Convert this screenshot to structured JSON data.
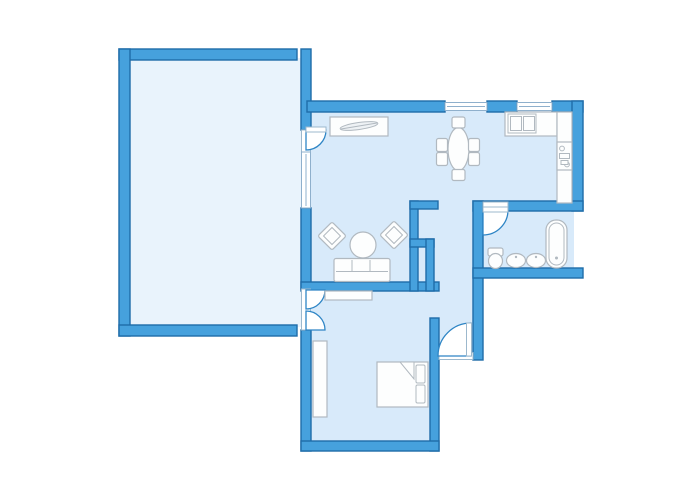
{
  "canvas": {
    "width": 700,
    "height": 500,
    "background": "#ffffff"
  },
  "palette": {
    "wall_fill": "#46a1dd",
    "wall_stroke": "#1e6ca9",
    "room_fill": "#d8eafa",
    "terrace_fill": "#e9f3fc",
    "opening_fill": "#ffffff",
    "opening_stroke": "#9cb8cd",
    "window_stroke": "#8fb0cc",
    "door_arc_stroke": "#2e85c5",
    "furniture_fill": "#fdfefe",
    "furniture_stroke": "#b1b9c0",
    "decor_fill": "#eef2f5"
  },
  "shapes": [
    {
      "name": "terrace-room-floor",
      "kind": "rect",
      "x": 128,
      "y": 58,
      "w": 175,
      "h": 269,
      "fill": "#e9f3fc"
    },
    {
      "name": "dining-kitchen-floor",
      "kind": "rect",
      "x": 306,
      "y": 110,
      "w": 268,
      "h": 95,
      "fill": "#d8eafa"
    },
    {
      "name": "living-room-floor",
      "kind": "rect",
      "x": 306,
      "y": 203,
      "w": 169,
      "h": 82,
      "fill": "#d8eafa"
    },
    {
      "name": "corridor-floor",
      "kind": "rect",
      "x": 430,
      "y": 285,
      "w": 47,
      "h": 70,
      "fill": "#d8eafa"
    },
    {
      "name": "bedroom-floor",
      "kind": "rect",
      "x": 306,
      "y": 285,
      "w": 130,
      "h": 158,
      "fill": "#d8eafa"
    },
    {
      "name": "bathroom-floor",
      "kind": "rect",
      "x": 481,
      "y": 209,
      "w": 93,
      "h": 61,
      "fill": "#d8eafa"
    },
    {
      "name": "wall-terrace-top",
      "kind": "rect",
      "x": 119,
      "y": 49,
      "w": 178,
      "h": 11,
      "fill": "#46a1dd",
      "stroke": "#1e6ca9",
      "sw": 1.4
    },
    {
      "name": "wall-terrace-left",
      "kind": "rect",
      "x": 119,
      "y": 49,
      "w": 11,
      "h": 287,
      "fill": "#46a1dd",
      "stroke": "#1e6ca9",
      "sw": 1.4
    },
    {
      "name": "wall-terrace-bottom",
      "kind": "rect",
      "x": 119,
      "y": 325,
      "w": 178,
      "h": 11,
      "fill": "#46a1dd",
      "stroke": "#1e6ca9",
      "sw": 1.4
    },
    {
      "name": "wall-west-upper",
      "kind": "rect",
      "x": 301,
      "y": 49,
      "w": 10,
      "h": 81,
      "fill": "#46a1dd",
      "stroke": "#1e6ca9",
      "sw": 1.4
    },
    {
      "name": "wall-west-mid",
      "kind": "rect",
      "x": 301,
      "y": 208,
      "w": 10,
      "h": 81,
      "fill": "#46a1dd",
      "stroke": "#1e6ca9",
      "sw": 1.4
    },
    {
      "name": "wall-west-lower",
      "kind": "rect",
      "x": 301,
      "y": 330,
      "w": 10,
      "h": 121,
      "fill": "#46a1dd",
      "stroke": "#1e6ca9",
      "sw": 1.4
    },
    {
      "name": "wall-north-1",
      "kind": "rect",
      "x": 307,
      "y": 101,
      "w": 138,
      "h": 11,
      "fill": "#46a1dd",
      "stroke": "#1e6ca9",
      "sw": 1.4
    },
    {
      "name": "wall-north-2",
      "kind": "rect",
      "x": 487,
      "y": 101,
      "w": 30,
      "h": 11,
      "fill": "#46a1dd",
      "stroke": "#1e6ca9",
      "sw": 1.4
    },
    {
      "name": "wall-north-3",
      "kind": "rect",
      "x": 552,
      "y": 101,
      "w": 31,
      "h": 11,
      "fill": "#46a1dd",
      "stroke": "#1e6ca9",
      "sw": 1.4
    },
    {
      "name": "wall-east-upper",
      "kind": "rect",
      "x": 572,
      "y": 101,
      "w": 11,
      "h": 110,
      "fill": "#46a1dd",
      "stroke": "#1e6ca9",
      "sw": 1.4
    },
    {
      "name": "wall-bathroom-top",
      "kind": "rect",
      "x": 473,
      "y": 201,
      "w": 110,
      "h": 10,
      "fill": "#46a1dd",
      "stroke": "#1e6ca9",
      "sw": 1.4
    },
    {
      "name": "wall-bathroom-left",
      "kind": "rect",
      "x": 473,
      "y": 201,
      "w": 10,
      "h": 159,
      "fill": "#46a1dd",
      "stroke": "#1e6ca9",
      "sw": 1.4
    },
    {
      "name": "wall-bathroom-bottom",
      "kind": "rect",
      "x": 473,
      "y": 268,
      "w": 110,
      "h": 10,
      "fill": "#46a1dd",
      "stroke": "#1e6ca9",
      "sw": 1.4
    },
    {
      "name": "wall-living-bottom",
      "kind": "rect",
      "x": 301,
      "y": 282,
      "w": 138,
      "h": 9,
      "fill": "#46a1dd",
      "stroke": "#1e6ca9",
      "sw": 1.4
    },
    {
      "name": "wall-closet-spine",
      "kind": "rect",
      "x": 410,
      "y": 201,
      "w": 8,
      "h": 90,
      "fill": "#46a1dd",
      "stroke": "#1e6ca9",
      "sw": 1.4
    },
    {
      "name": "wall-closet-top-arm",
      "kind": "rect",
      "x": 410,
      "y": 201,
      "w": 28,
      "h": 8,
      "fill": "#46a1dd",
      "stroke": "#1e6ca9",
      "sw": 1.4
    },
    {
      "name": "wall-closet-mid-arm",
      "kind": "rect",
      "x": 410,
      "y": 239,
      "w": 24,
      "h": 8,
      "fill": "#46a1dd",
      "stroke": "#1e6ca9",
      "sw": 1.4
    },
    {
      "name": "wall-closet-right",
      "kind": "rect",
      "x": 426,
      "y": 239,
      "w": 8,
      "h": 52,
      "fill": "#46a1dd",
      "stroke": "#1e6ca9",
      "sw": 1.4
    },
    {
      "name": "wall-bedroom-east",
      "kind": "rect",
      "x": 430,
      "y": 318,
      "w": 9,
      "h": 133,
      "fill": "#46a1dd",
      "stroke": "#1e6ca9",
      "sw": 1.4
    },
    {
      "name": "wall-bedroom-bottom",
      "kind": "rect",
      "x": 301,
      "y": 441,
      "w": 138,
      "h": 10,
      "fill": "#46a1dd",
      "stroke": "#1e6ca9",
      "sw": 1.4
    },
    {
      "name": "terrace-door-opening",
      "kind": "rect",
      "x": 301.5,
      "y": 130,
      "w": 9,
      "h": 22,
      "fill": "#ffffff",
      "stroke": "#9cb8cd",
      "sw": 1
    },
    {
      "name": "double-door-opening",
      "kind": "rect",
      "x": 301.5,
      "y": 289,
      "w": 9,
      "h": 41,
      "fill": "#ffffff",
      "stroke": "#9cb8cd",
      "sw": 1
    },
    {
      "name": "bathroom-door-opening",
      "kind": "rect",
      "x": 483,
      "y": 202,
      "w": 25,
      "h": 8,
      "fill": "#ffffff",
      "stroke": "#9cb8cd",
      "sw": 1
    },
    {
      "name": "entrance-door-opening",
      "kind": "rect",
      "x": 439,
      "y": 352.5,
      "w": 34,
      "h": 7,
      "fill": "#ffffff",
      "stroke": "#9cb8cd",
      "sw": 1
    },
    {
      "name": "window-west",
      "kind": "rect",
      "x": 301.5,
      "y": 152,
      "w": 9,
      "h": 56,
      "fill": "#ffffff",
      "stroke": "#8fb0cc",
      "sw": 1
    },
    {
      "name": "window-west-mullion",
      "kind": "line",
      "x1": 306,
      "y1": 154,
      "x2": 306,
      "y2": 206,
      "stroke": "#8fb0cc",
      "sw": 1
    },
    {
      "name": "window-north-1",
      "kind": "rect",
      "x": 445,
      "y": 102.5,
      "w": 42,
      "h": 8,
      "fill": "#ffffff",
      "stroke": "#8fb0cc",
      "sw": 1
    },
    {
      "name": "window-north-1-mullion",
      "kind": "line",
      "x1": 447,
      "y1": 106.5,
      "x2": 485,
      "y2": 106.5,
      "stroke": "#8fb0cc",
      "sw": 1
    },
    {
      "name": "window-north-2",
      "kind": "rect",
      "x": 517,
      "y": 102.5,
      "w": 35,
      "h": 8,
      "fill": "#ffffff",
      "stroke": "#8fb0cc",
      "sw": 1
    },
    {
      "name": "window-north-2-mullion",
      "kind": "line",
      "x1": 519,
      "y1": 106.5,
      "x2": 550,
      "y2": 106.5,
      "stroke": "#8fb0cc",
      "sw": 1
    },
    {
      "name": "terrace-door-arc",
      "kind": "path",
      "d": "M 306,130 L 326,130 A 20,20 0 0 1 306,150 Z",
      "fill": "#ffffff",
      "stroke": "#2e85c5",
      "sw": 1.3
    },
    {
      "name": "terrace-door-leaf",
      "kind": "rect",
      "x": 306,
      "y": 127,
      "w": 20,
      "h": 5,
      "fill": "#ffffff",
      "stroke": "#9cb8cd",
      "sw": 1
    },
    {
      "name": "double-door-upper-arc",
      "kind": "path",
      "d": "M 306,290 L 325,290 A 19,19 0 0 1 306,309 Z",
      "fill": "#ffffff",
      "stroke": "#2e85c5",
      "sw": 1.3
    },
    {
      "name": "double-door-lower-arc",
      "kind": "path",
      "d": "M 306,330 L 306,311 A 19,19 0 0 1 325,330 Z",
      "fill": "#ffffff",
      "stroke": "#2e85c5",
      "sw": 1.3
    },
    {
      "name": "bathroom-door-arc",
      "kind": "path",
      "d": "M 483,210 L 508,210 A 25,25 0 0 1 483,235 Z",
      "fill": "#ffffff",
      "stroke": "#2e85c5",
      "sw": 1.3
    },
    {
      "name": "bathroom-door-leaf",
      "kind": "rect",
      "x": 483,
      "y": 207,
      "w": 25,
      "h": 5,
      "fill": "#ffffff",
      "stroke": "#9cb8cd",
      "sw": 1
    },
    {
      "name": "entrance-door-arc",
      "kind": "path",
      "d": "M 471,356 L 471,323 A 33,33 0 0 0 438,356 Z",
      "fill": "#ffffff",
      "stroke": "#2e85c5",
      "sw": 1.3
    },
    {
      "name": "entrance-door-leaf",
      "kind": "rect",
      "x": 466.5,
      "y": 323,
      "w": 5,
      "h": 33,
      "fill": "#ffffff",
      "stroke": "#9cb8cd",
      "sw": 1
    },
    {
      "name": "sideboard",
      "kind": "rect",
      "x": 330,
      "y": 117,
      "w": 58,
      "h": 19,
      "fill": "#fdfefe",
      "stroke": "#b1b9c0",
      "sw": 1.2
    },
    {
      "name": "plant-decor",
      "kind": "ellipse",
      "cx": 359,
      "cy": 126,
      "rx": 19,
      "ry": 3.5,
      "transform": "rotate(-8 359 126)",
      "fill": "#eef2f5",
      "stroke": "#b1b9c0",
      "sw": 1
    },
    {
      "name": "plant-decor-stem",
      "kind": "line",
      "x1": 341,
      "y1": 129,
      "x2": 377,
      "y2": 123,
      "stroke": "#b1b9c0",
      "sw": 1
    },
    {
      "name": "dining-table",
      "kind": "ellipse",
      "cx": 458.5,
      "cy": 149,
      "rx": 10.5,
      "ry": 21.5,
      "fill": "#fdfefe",
      "stroke": "#b1b9c0",
      "sw": 1.2
    },
    {
      "name": "dining-chair-top",
      "kind": "rect",
      "x": 452,
      "y": 117,
      "w": 13,
      "h": 11,
      "rx": 2,
      "fill": "#fdfefe",
      "stroke": "#b1b9c0",
      "sw": 1.2
    },
    {
      "name": "dining-chair-bottom",
      "kind": "rect",
      "x": 452,
      "y": 169.5,
      "w": 13,
      "h": 11,
      "rx": 2,
      "fill": "#fdfefe",
      "stroke": "#b1b9c0",
      "sw": 1.2
    },
    {
      "name": "dining-chair-left-1",
      "kind": "rect",
      "x": 436.5,
      "y": 138.5,
      "w": 11,
      "h": 13,
      "rx": 2,
      "fill": "#fdfefe",
      "stroke": "#b1b9c0",
      "sw": 1.2
    },
    {
      "name": "dining-chair-left-2",
      "kind": "rect",
      "x": 436.5,
      "y": 152.5,
      "w": 11,
      "h": 13,
      "rx": 2,
      "fill": "#fdfefe",
      "stroke": "#b1b9c0",
      "sw": 1.2
    },
    {
      "name": "dining-chair-right-1",
      "kind": "rect",
      "x": 468.5,
      "y": 138.5,
      "w": 11,
      "h": 13,
      "rx": 2,
      "fill": "#fdfefe",
      "stroke": "#b1b9c0",
      "sw": 1.2
    },
    {
      "name": "dining-chair-right-2",
      "kind": "rect",
      "x": 468.5,
      "y": 152.5,
      "w": 11,
      "h": 13,
      "rx": 2,
      "fill": "#fdfefe",
      "stroke": "#b1b9c0",
      "sw": 1.2
    },
    {
      "name": "armchair-1",
      "kind": "rect",
      "x": 322,
      "y": 226,
      "w": 20,
      "h": 20,
      "rx": 2,
      "transform": "rotate(45 332 236)",
      "fill": "#fdfefe",
      "stroke": "#b1b9c0",
      "sw": 1.2
    },
    {
      "name": "armchair-1-cushion",
      "kind": "rect",
      "x": 326,
      "y": 230,
      "w": 12,
      "h": 12,
      "transform": "rotate(45 332 236)",
      "fill": "#fdfefe",
      "stroke": "#b1b9c0",
      "sw": 1
    },
    {
      "name": "armchair-2",
      "kind": "rect",
      "x": 384,
      "y": 225,
      "w": 20,
      "h": 20,
      "rx": 2,
      "transform": "rotate(45 394 235)",
      "fill": "#fdfefe",
      "stroke": "#b1b9c0",
      "sw": 1.2
    },
    {
      "name": "armchair-2-cushion",
      "kind": "rect",
      "x": 388,
      "y": 229,
      "w": 12,
      "h": 12,
      "transform": "rotate(45 394 235)",
      "fill": "#fdfefe",
      "stroke": "#b1b9c0",
      "sw": 1
    },
    {
      "name": "coffee-table",
      "kind": "circle",
      "cx": 363,
      "cy": 245,
      "r": 13,
      "fill": "#fdfefe",
      "stroke": "#b1b9c0",
      "sw": 1.2
    },
    {
      "name": "sofa",
      "kind": "rect",
      "x": 334,
      "y": 258.5,
      "w": 56,
      "h": 23,
      "rx": 2,
      "fill": "#fdfefe",
      "stroke": "#b1b9c0",
      "sw": 1.2
    },
    {
      "name": "sofa-seat-line",
      "kind": "line",
      "x1": 336,
      "y1": 271.5,
      "x2": 388,
      "y2": 271.5,
      "stroke": "#b1b9c0",
      "sw": 1
    },
    {
      "name": "sofa-cushion-div-1",
      "kind": "line",
      "x1": 352,
      "y1": 260,
      "x2": 352,
      "y2": 271.5,
      "stroke": "#b1b9c0",
      "sw": 1
    },
    {
      "name": "sofa-cushion-div-2",
      "kind": "line",
      "x1": 370,
      "y1": 260,
      "x2": 370,
      "y2": 271.5,
      "stroke": "#b1b9c0",
      "sw": 1
    },
    {
      "name": "kitchen-counter-top",
      "kind": "rect",
      "x": 505,
      "y": 112,
      "w": 52,
      "h": 24,
      "fill": "#fdfefe",
      "stroke": "#b1b9c0",
      "sw": 1.2
    },
    {
      "name": "kitchen-counter-right",
      "kind": "rect",
      "x": 557,
      "y": 112,
      "w": 15,
      "h": 91,
      "fill": "#fdfefe",
      "stroke": "#b1b9c0",
      "sw": 1.2
    },
    {
      "name": "kitchen-sink",
      "kind": "rect",
      "x": 508,
      "y": 114,
      "w": 28,
      "h": 19,
      "fill": "#fdfefe",
      "stroke": "#b1b9c0",
      "sw": 1
    },
    {
      "name": "kitchen-sink-basin-1",
      "kind": "rect",
      "x": 510.5,
      "y": 116.5,
      "w": 11,
      "h": 14,
      "fill": "#fdfefe",
      "stroke": "#b1b9c0",
      "sw": 1
    },
    {
      "name": "kitchen-sink-basin-2",
      "kind": "rect",
      "x": 523.5,
      "y": 116.5,
      "w": 11,
      "h": 14,
      "fill": "#fdfefe",
      "stroke": "#b1b9c0",
      "sw": 1
    },
    {
      "name": "stove",
      "kind": "rect",
      "x": 557,
      "y": 142,
      "w": 15,
      "h": 28,
      "fill": "#fdfefe",
      "stroke": "#b1b9c0",
      "sw": 1.2
    },
    {
      "name": "stove-burner-1",
      "kind": "circle",
      "cx": 562,
      "cy": 148.5,
      "r": 2.4,
      "fill": "#fdfefe",
      "stroke": "#b1b9c0",
      "sw": 1
    },
    {
      "name": "stove-burner-2",
      "kind": "circle",
      "cx": 567,
      "cy": 164.5,
      "r": 2.4,
      "fill": "#fdfefe",
      "stroke": "#b1b9c0",
      "sw": 1
    },
    {
      "name": "stove-control-1",
      "kind": "rect",
      "x": 559.5,
      "y": 153.5,
      "w": 10,
      "h": 5,
      "fill": "#fdfefe",
      "stroke": "#b1b9c0",
      "sw": 1
    },
    {
      "name": "stove-control-2",
      "kind": "rect",
      "x": 561,
      "y": 160.5,
      "w": 7,
      "h": 4,
      "fill": "#fdfefe",
      "stroke": "#b1b9c0",
      "sw": 1
    },
    {
      "name": "toilet-tank",
      "kind": "rect",
      "x": 488,
      "y": 248,
      "w": 15,
      "h": 8,
      "rx": 2,
      "fill": "#fdfefe",
      "stroke": "#b1b9c0",
      "sw": 1.2
    },
    {
      "name": "toilet-bowl",
      "kind": "ellipse",
      "cx": 495.5,
      "cy": 261,
      "rx": 7,
      "ry": 7.5,
      "fill": "#fdfefe",
      "stroke": "#b1b9c0",
      "sw": 1.2
    },
    {
      "name": "bathroom-sink-1",
      "kind": "ellipse",
      "cx": 516,
      "cy": 260.5,
      "rx": 9.5,
      "ry": 7,
      "fill": "#fdfefe",
      "stroke": "#b1b9c0",
      "sw": 1.2
    },
    {
      "name": "bathroom-sink-1-faucet",
      "kind": "circle",
      "cx": 516,
      "cy": 257,
      "r": 1.2,
      "fill": "#b1b9c0"
    },
    {
      "name": "bathroom-sink-2",
      "kind": "ellipse",
      "cx": 536,
      "cy": 260.5,
      "rx": 9.5,
      "ry": 7,
      "fill": "#fdfefe",
      "stroke": "#b1b9c0",
      "sw": 1.2
    },
    {
      "name": "bathroom-sink-2-faucet",
      "kind": "circle",
      "cx": 536,
      "cy": 257,
      "r": 1.2,
      "fill": "#b1b9c0"
    },
    {
      "name": "bathtub",
      "kind": "rect",
      "x": 546,
      "y": 220,
      "w": 21,
      "h": 48,
      "rx": 10,
      "fill": "#fdfefe",
      "stroke": "#b1b9c0",
      "sw": 1.2
    },
    {
      "name": "bathtub-inner",
      "kind": "rect",
      "x": 549,
      "y": 223,
      "w": 15,
      "h": 42,
      "rx": 7.5,
      "fill": "#fdfefe",
      "stroke": "#b1b9c0",
      "sw": 1
    },
    {
      "name": "bathtub-drain",
      "kind": "circle",
      "cx": 556.5,
      "cy": 258,
      "r": 1.5,
      "fill": "#b1b9c0"
    },
    {
      "name": "bedroom-dresser",
      "kind": "rect",
      "x": 325,
      "y": 291,
      "w": 47,
      "h": 9,
      "fill": "#fdfefe",
      "stroke": "#b1b9c0",
      "sw": 1.2
    },
    {
      "name": "wardrobe",
      "kind": "rect",
      "x": 313,
      "y": 341,
      "w": 14,
      "h": 76,
      "fill": "#fdfefe",
      "stroke": "#b1b9c0",
      "sw": 1.2
    },
    {
      "name": "bed",
      "kind": "rect",
      "x": 377,
      "y": 362,
      "w": 51,
      "h": 45,
      "fill": "#fdfefe",
      "stroke": "#b1b9c0",
      "sw": 1.2
    },
    {
      "name": "bed-pillow-1",
      "kind": "rect",
      "x": 416,
      "y": 365,
      "w": 9,
      "h": 18,
      "rx": 1.5,
      "fill": "#fdfefe",
      "stroke": "#b1b9c0",
      "sw": 1
    },
    {
      "name": "bed-pillow-2",
      "kind": "rect",
      "x": 416,
      "y": 385,
      "w": 9,
      "h": 18,
      "rx": 1.5,
      "fill": "#fdfefe",
      "stroke": "#b1b9c0",
      "sw": 1
    },
    {
      "name": "bed-blanket-fold",
      "kind": "path",
      "d": "M 400,362 L 414,362 L 414,379 Z",
      "fill": "#fdfefe",
      "stroke": "#b1b9c0",
      "sw": 1
    }
  ]
}
